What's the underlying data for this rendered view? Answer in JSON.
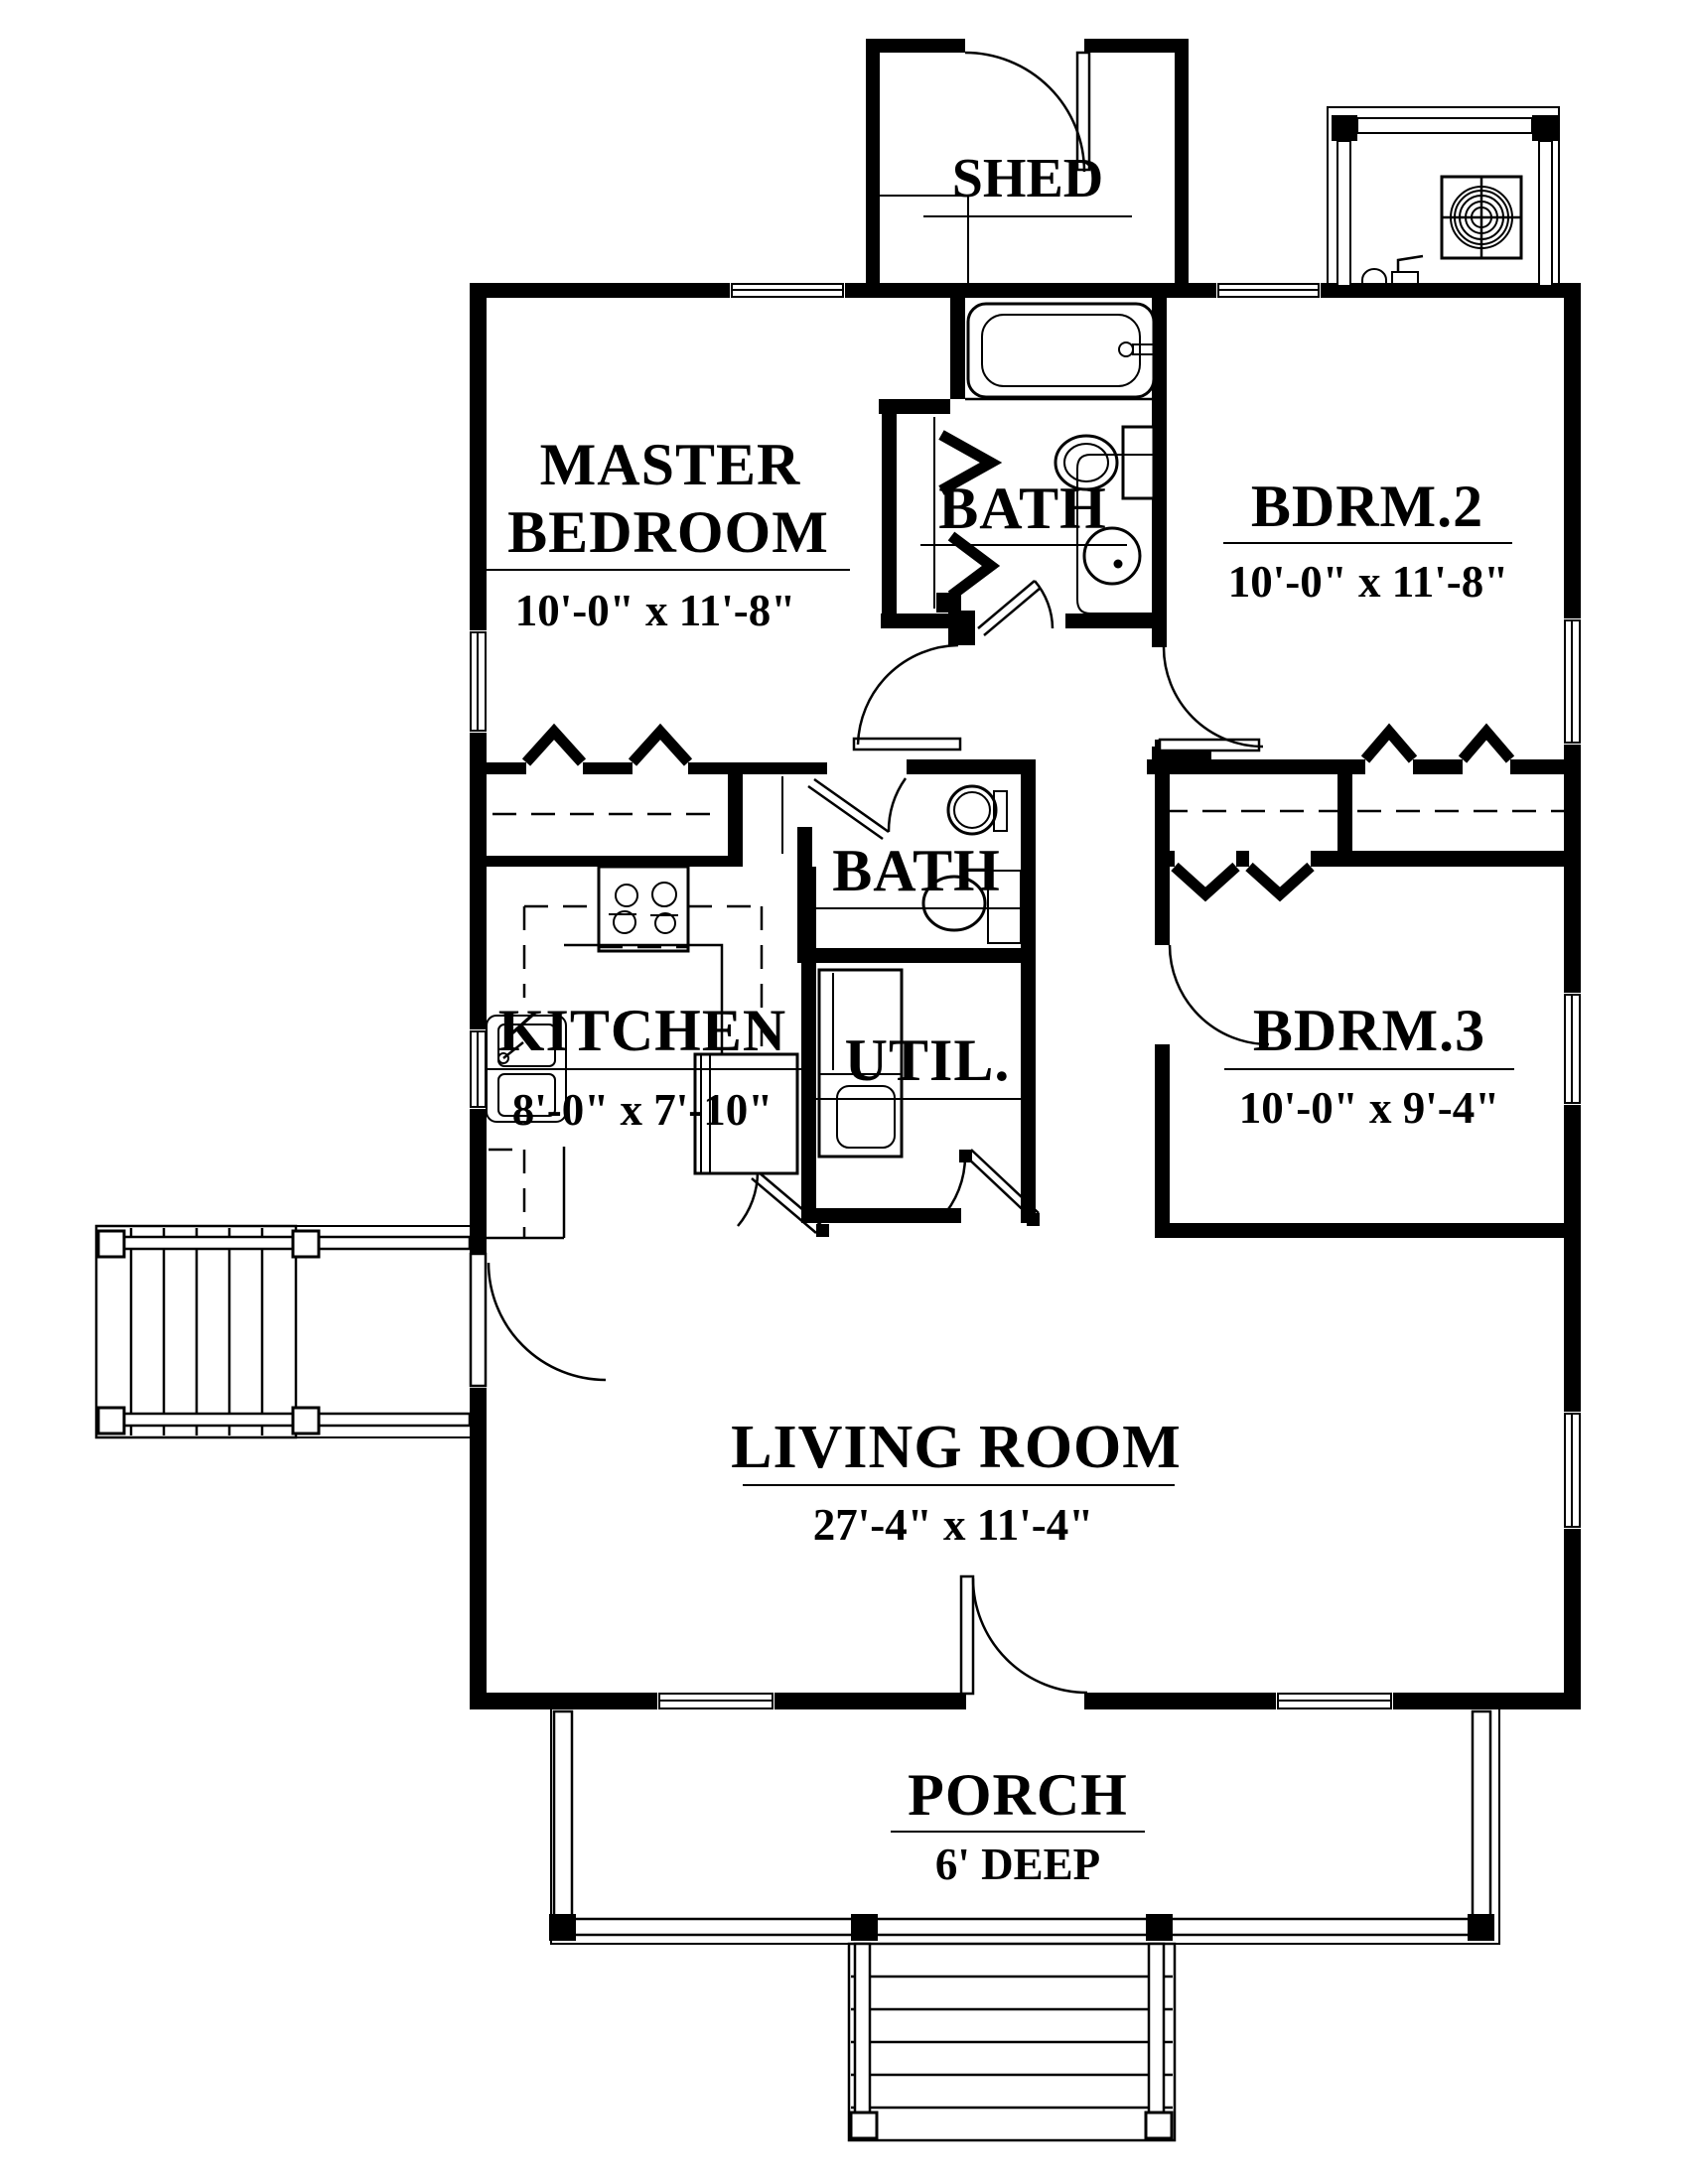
{
  "colors": {
    "ink": "#000000",
    "paper": "#ffffff"
  },
  "rooms": {
    "shed": {
      "name": "SHED"
    },
    "master": {
      "line1": "MASTER",
      "line2": "BEDROOM",
      "dims": "10'-0\" x 11'-8\""
    },
    "bath1": {
      "name": "BATH"
    },
    "bdrm2": {
      "name": "BDRM.2",
      "dims": "10'-0\" x 11'-8\""
    },
    "bath2": {
      "name": "BATH"
    },
    "kitchen": {
      "name": "KITCHEN",
      "dims": "8'-0\" x 7'-10\""
    },
    "util": {
      "name": "UTIL."
    },
    "bdrm3": {
      "name": "BDRM.3",
      "dims": "10'-0\" x 9'-4\""
    },
    "living": {
      "name": "LIVING ROOM",
      "dims": "27'-4\" x 11'-4\""
    },
    "porch": {
      "name": "PORCH",
      "dims": "6' DEEP"
    }
  }
}
